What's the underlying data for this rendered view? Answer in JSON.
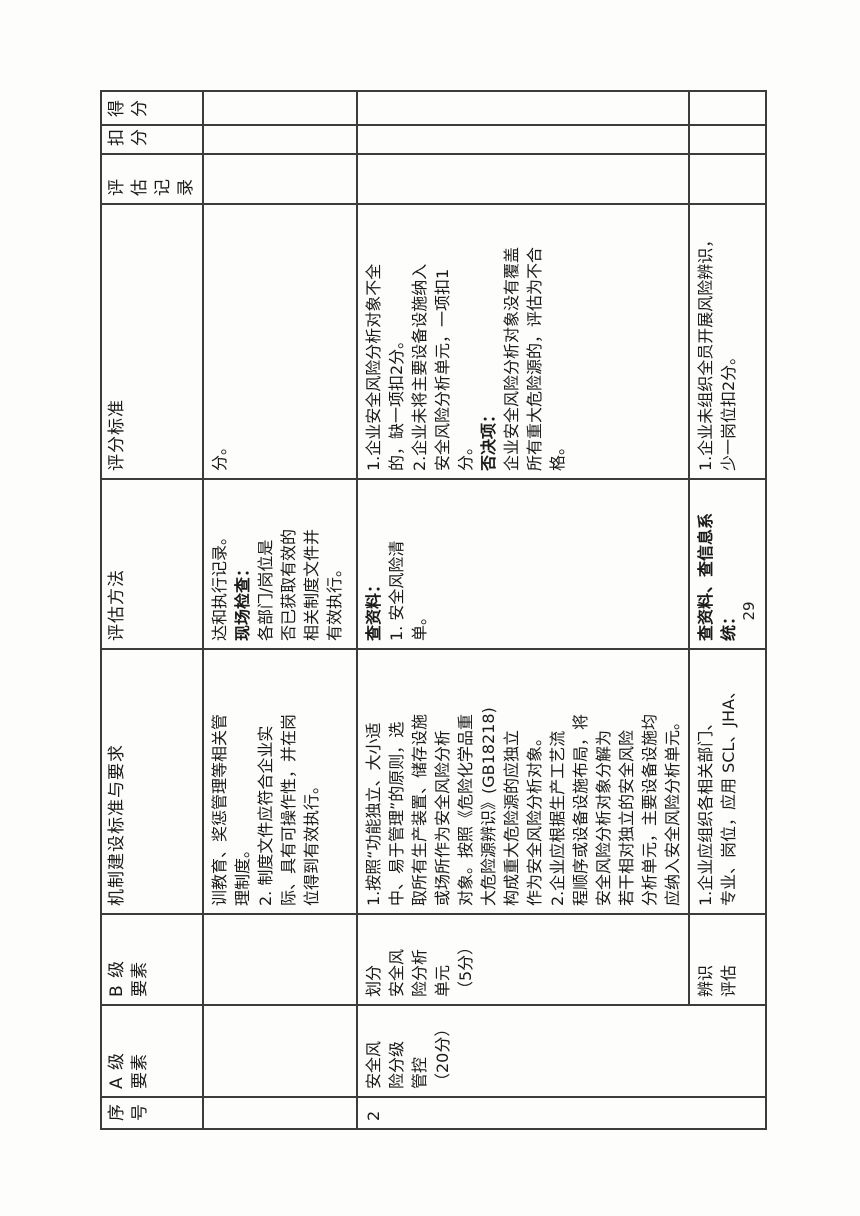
{
  "page_number": "29",
  "table": {
    "headers": {
      "serial": "序\n号",
      "level_a": "A 级\n要素",
      "level_b": "B 级\n要素",
      "mechanism": "机制建设标准与要求",
      "method": "评估方法",
      "scoring": "评分标准",
      "record": "评估\n记录",
      "deduction": "扣\n分",
      "score": "得\n分"
    },
    "row1": {
      "mechanism": "训教育、奖惩管理等相关管\n理制度。\n2. 制度文件应符合企业实\n际、具有可操作性，并在岗\n位得到有效执行。",
      "method_intro": "达和执行记录。",
      "method_check_label": "现场检查：",
      "method_check_body": "各部门/岗位是\n否已获取有效的\n相关制度文件并\n有效执行。",
      "scoring": "分。"
    },
    "row2": {
      "serial": "2",
      "level_a": "安全风\n险分级\n管控\n（20分）",
      "level_b": "划分\n安全风\n险分析\n单元\n（5分）",
      "mechanism": "1.按照“功能独立、大小适\n中、易于管理”的原则，选\n取所有生产装置、储存设施\n或场所作为安全风险分析\n对象。按照《危险化学品重\n大危险源辨识》(GB18218)\n构成重大危险源的应独立\n作为安全风险分析对象。\n2.企业应根据生产工艺流\n程顺序或设备设施布局，将\n安全风险分析对象分解为\n若干相对独立的安全风险\n分析单元，主要设备设施均\n应纳入安全风险分析单元。",
      "method_label": "查资料：",
      "method_body": "1. 安全风险清\n单。",
      "scoring_part1": "1.企业安全风险分析对象不全\n的，缺一项扣2分。\n2.企业未将主要设备设施纳入\n安全风险分析单元，一项扣1\n分。",
      "scoring_veto_label": "否决项：",
      "scoring_veto_body": "企业安全风险分析对象没有覆盖\n所有重大危险源的，评估为不合\n格。"
    },
    "row3": {
      "level_b": "辨识\n评估",
      "mechanism": "1.企业应组织各相关部门、\n专业、岗位，应用 SCL、JHA、",
      "method_label": "查资料、查信息系\n统：",
      "scoring": "1.企业未组织全员开展风险辨识，\n少一岗位扣2分。"
    }
  }
}
